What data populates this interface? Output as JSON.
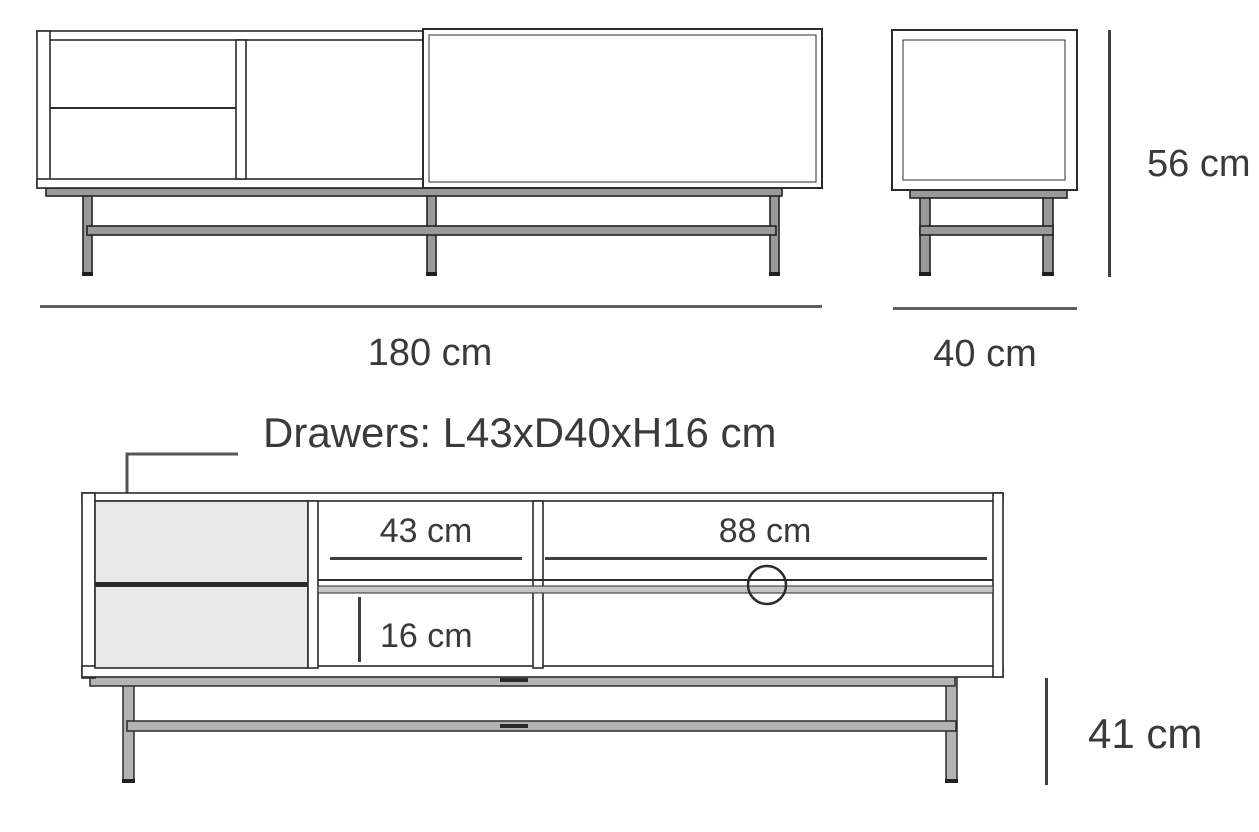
{
  "diagram": {
    "labels": {
      "front_width": "180 cm",
      "side_width": "40 cm",
      "side_height": "56 cm",
      "drawers_note": "Drawers: L43xD40xH16 cm",
      "shelf_width": "43 cm",
      "door_width": "88 cm",
      "opening_height": "16 cm",
      "leg_height": "41 cm"
    },
    "dimensions_cm": {
      "overall_width": 180,
      "overall_depth": 40,
      "overall_height": 56,
      "drawer_length": 43,
      "drawer_depth": 40,
      "drawer_height": 16,
      "shelf_width": 43,
      "door_width": 88,
      "opening_height": 16,
      "leg_height": 41
    },
    "colors": {
      "outline": "#2b2b2b",
      "dimension_line": "#5f5f5f",
      "text": "#3a3a3a",
      "drawer_fill": "#e9e9e9",
      "metal_fill": "#b3b3b3",
      "background": "#ffffff"
    }
  }
}
